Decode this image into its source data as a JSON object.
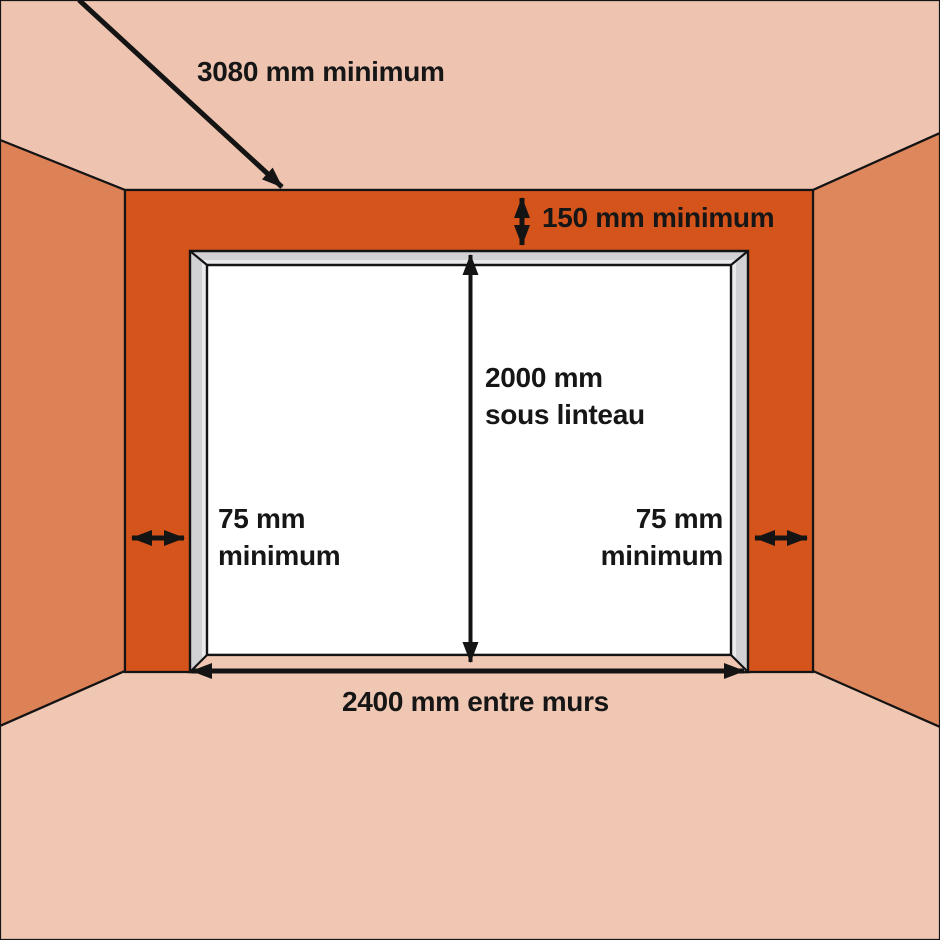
{
  "labels": {
    "overall_width": "3080 mm minimum",
    "lintel_margin": "150 mm minimum",
    "height_line1": "2000 mm",
    "height_line2": "sous linteau",
    "left_margin_line1": "75 mm",
    "left_margin_line2": "minimum",
    "right_margin_line1": "75 mm",
    "right_margin_line2": "minimum",
    "opening_width": "2400 mm entre murs"
  },
  "colors": {
    "ceiling": "#eec4b1",
    "floor": "#f0c7b3",
    "left_wall": "#dd8157",
    "right_wall": "#de875c",
    "front_wall": "#d4541c",
    "frame": "#d2d2d4",
    "frame_highlight": "#eaeaec",
    "opening": "#ffffff",
    "threshold": "#f0c7b3",
    "outline": "#141414",
    "arrow": "#141414"
  }
}
